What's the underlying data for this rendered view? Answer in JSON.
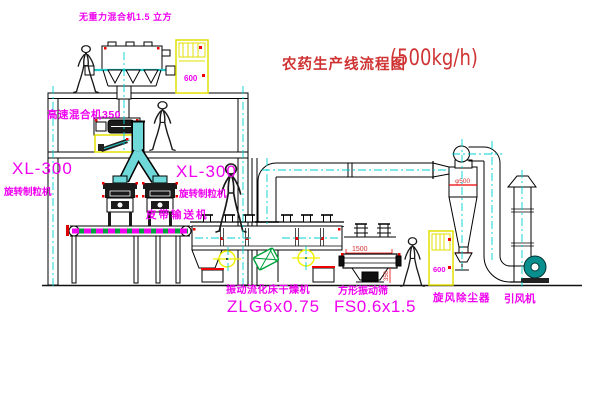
{
  "title": {
    "text": "农药生产线流程图",
    "capacity": "(500kg/h)"
  },
  "labels": {
    "gravity_mixer": "无重力混合机1.5 立方",
    "high_speed_mixer": "高速混合机350",
    "granulator_left_model": "XL-300",
    "granulator_left_name": "旋转制粒机",
    "granulator_right_model": "XL-300",
    "granulator_right_name": "旋转制粒机",
    "belt_conveyor": "皮带输送机",
    "dryer_name": "振动流化床干燥机",
    "dryer_model": "ZLG6x0.75",
    "sieve_name": "方形振动筛",
    "sieve_model": "FS0.6x1.5",
    "cyclone": "旋风除尘器",
    "fan": "引风机"
  },
  "dimensions": {
    "cyclone_inlet_diameter": "φ500",
    "sieve_length": "1500",
    "sieve_height": "350",
    "cabinet_marking": "600"
  },
  "colors": {
    "label_magenta": "#ef00ef",
    "annotation_red": "#cf3333",
    "centerline_cyan": "#00d2d2",
    "pipe_cyan": "#6fd9d9",
    "highlight_yellow": "#f0f000",
    "motor_green": "#00a23c",
    "fan_teal": "#0a8f8f",
    "line_black": "#000000"
  }
}
